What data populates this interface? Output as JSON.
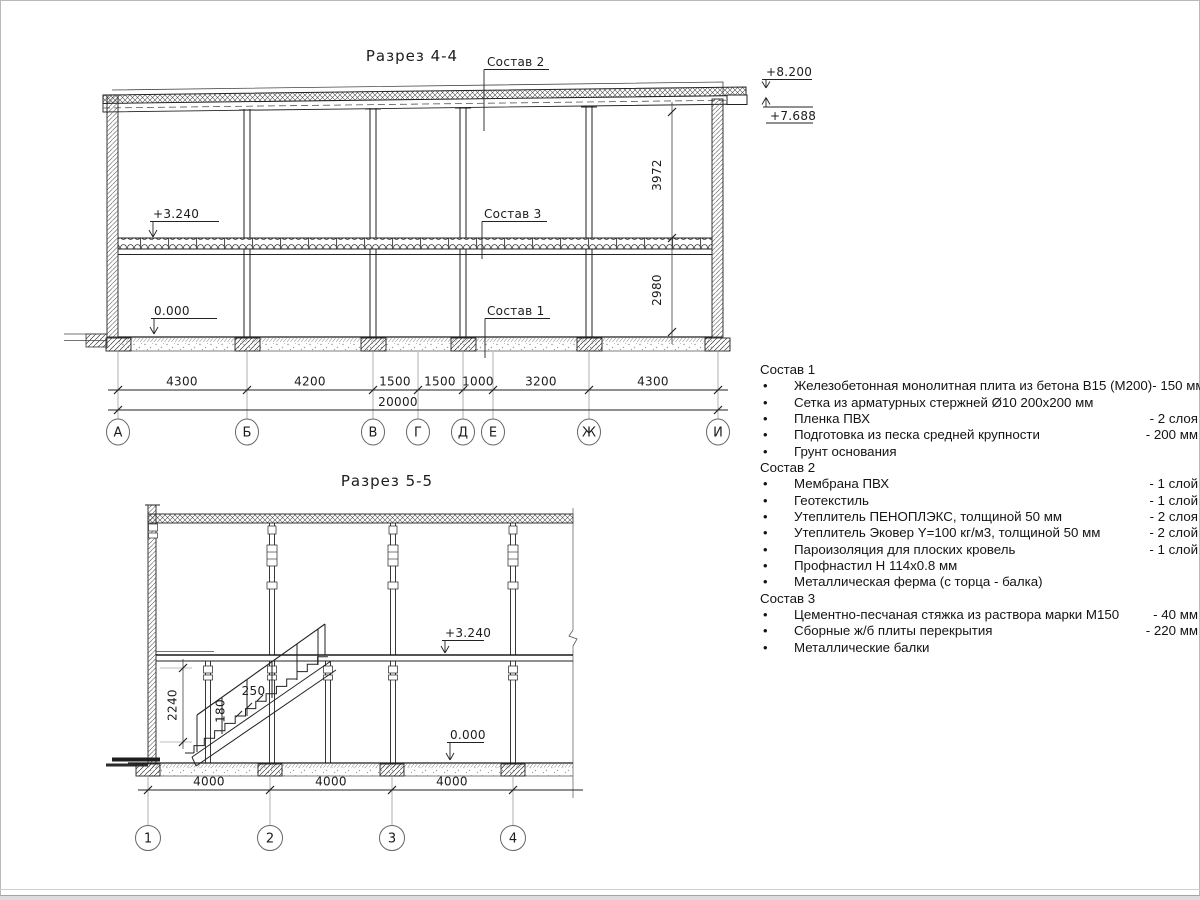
{
  "section44": {
    "title": "Разрез 4-4",
    "elev_roof_top": "+8.200",
    "elev_roof_low": "+7.688",
    "elev_floor": "+3.240",
    "elev_zero": "0.000",
    "dim_v_upper": "3972",
    "dim_v_lower": "2980",
    "leader_sostav2": "Состав 2",
    "leader_sostav3": "Состав 3",
    "leader_sostav1": "Состав 1",
    "dims_row1": [
      "4300",
      "4200",
      "1500",
      "1500",
      "1000",
      "3200",
      "4300"
    ],
    "dim_total": "20000",
    "axes": [
      "А",
      "Б",
      "В",
      "Г",
      "Д",
      "Е",
      "Ж",
      "И"
    ]
  },
  "section55": {
    "title": "Разрез 5-5",
    "elev_floor": "+3.240",
    "elev_zero": "0.000",
    "dim_stair_height": "2240",
    "dim_tread": "250",
    "dim_riser": "180",
    "dims_row1": [
      "4000",
      "4000",
      "4000"
    ],
    "axes": [
      "1",
      "2",
      "3",
      "4"
    ]
  },
  "legend": {
    "groups": [
      {
        "title": "Состав 1",
        "items": [
          {
            "text": "Железобетонная монолитная плита из бетона В15 (М200)",
            "value": "-  150 мм"
          },
          {
            "text": "Сетка из арматурных стержней Ø10 200х200 мм",
            "value": ""
          },
          {
            "text": "Пленка ПВХ",
            "value": "-  2 слоя"
          },
          {
            "text": "Подготовка из песка средней крупности",
            "value": "- 200 мм"
          },
          {
            "text": "Грунт основания",
            "value": ""
          }
        ]
      },
      {
        "title": "Состав 2",
        "items": [
          {
            "text": "Мембрана ПВХ",
            "value": "- 1 слой"
          },
          {
            "text": "Геотекстиль",
            "value": "- 1 слой"
          },
          {
            "text": "Утеплитель ПЕНОПЛЭКС, толщиной 50 мм",
            "value": "- 2 слоя"
          },
          {
            "text": "Утеплитель Эковер Y=100 кг/м3, толщиной 50 мм",
            "value": "- 2 слой"
          },
          {
            "text": "Пароизоляция для плоских кровель",
            "value": "- 1 слой"
          },
          {
            "text": "Профнастил Н 114х0.8 мм",
            "value": ""
          },
          {
            "text": "Металлическая ферма (с торца - балка)",
            "value": ""
          }
        ]
      },
      {
        "title": "Состав 3",
        "items": [
          {
            "text": "Цементно-песчаная стяжка из раствора марки М150",
            "value": "-  40 мм"
          },
          {
            "text": "Сборные ж/б плиты перекрытия",
            "value": "- 220 мм"
          },
          {
            "text": "Металлические балки",
            "value": ""
          }
        ]
      }
    ]
  }
}
